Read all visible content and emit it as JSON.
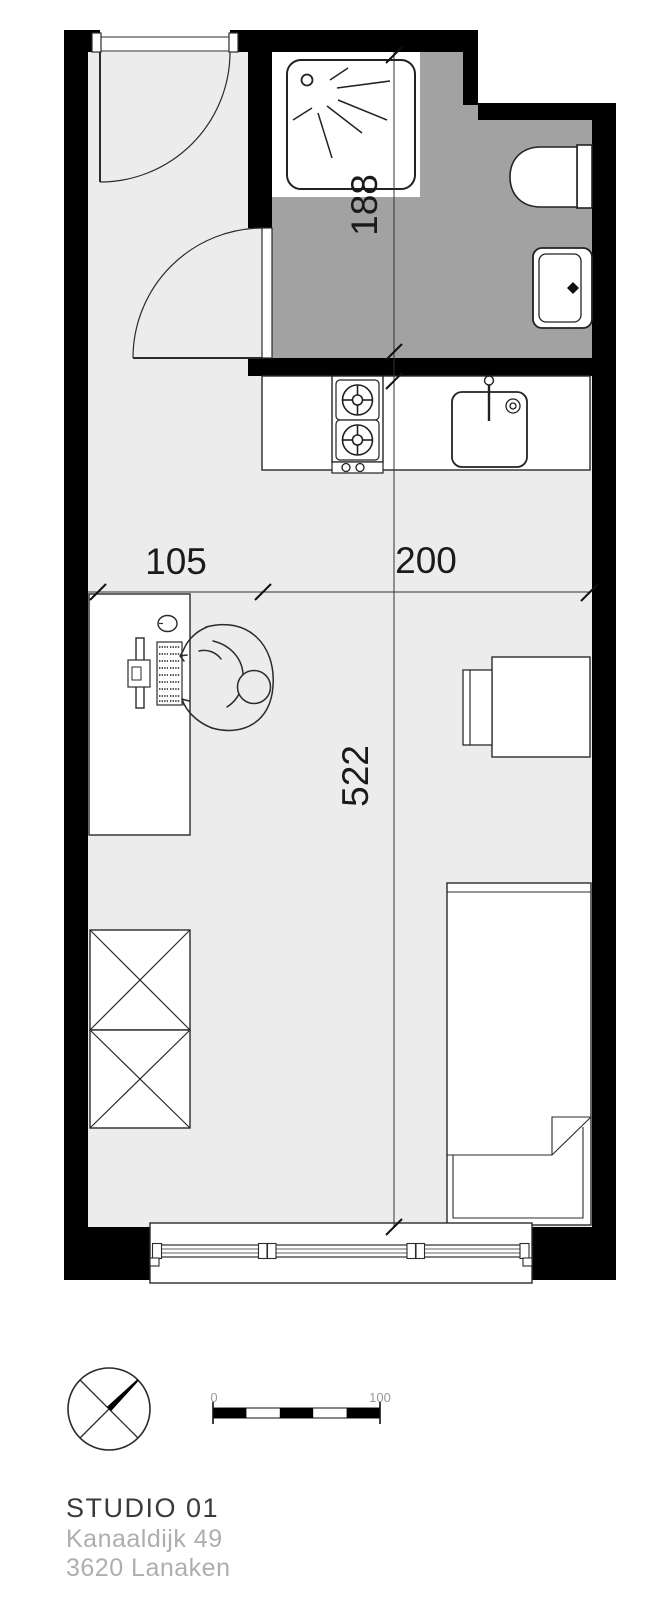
{
  "floor_plan": {
    "dimensions": {
      "bathroom_depth_cm": "188",
      "left_zone_width_cm": "105",
      "right_zone_width_cm": "200",
      "room_length_cm": "522"
    },
    "scale_bar": {
      "start_label": "0",
      "end_label": "100"
    },
    "footer": {
      "title": "STUDIO 01",
      "address_line_1": "Kanaaldijk 49",
      "address_line_2": "3620 Lanaken"
    },
    "colors": {
      "wall": "#000000",
      "room_floor": "#ececec",
      "bathroom_floor": "#a2a2a2",
      "fixture_fill": "#ffffff",
      "outline": "#2b2b2b",
      "dimension_text": "#1a1a1a",
      "muted_text": "#aeaeae",
      "title_text": "#3a3a3a"
    },
    "rooms": {
      "bathroom": "shower, toilet, washbasin",
      "kitchen": "two-burner stove, sink counter",
      "living": "desk with person, table with chair, wardrobe, single bed"
    },
    "icons": {
      "north_arrow": "compass-circle-north-pointer",
      "shower_spray": "radiating-spray-lines",
      "wardrobe_symbol": "crossed-boxes"
    }
  }
}
